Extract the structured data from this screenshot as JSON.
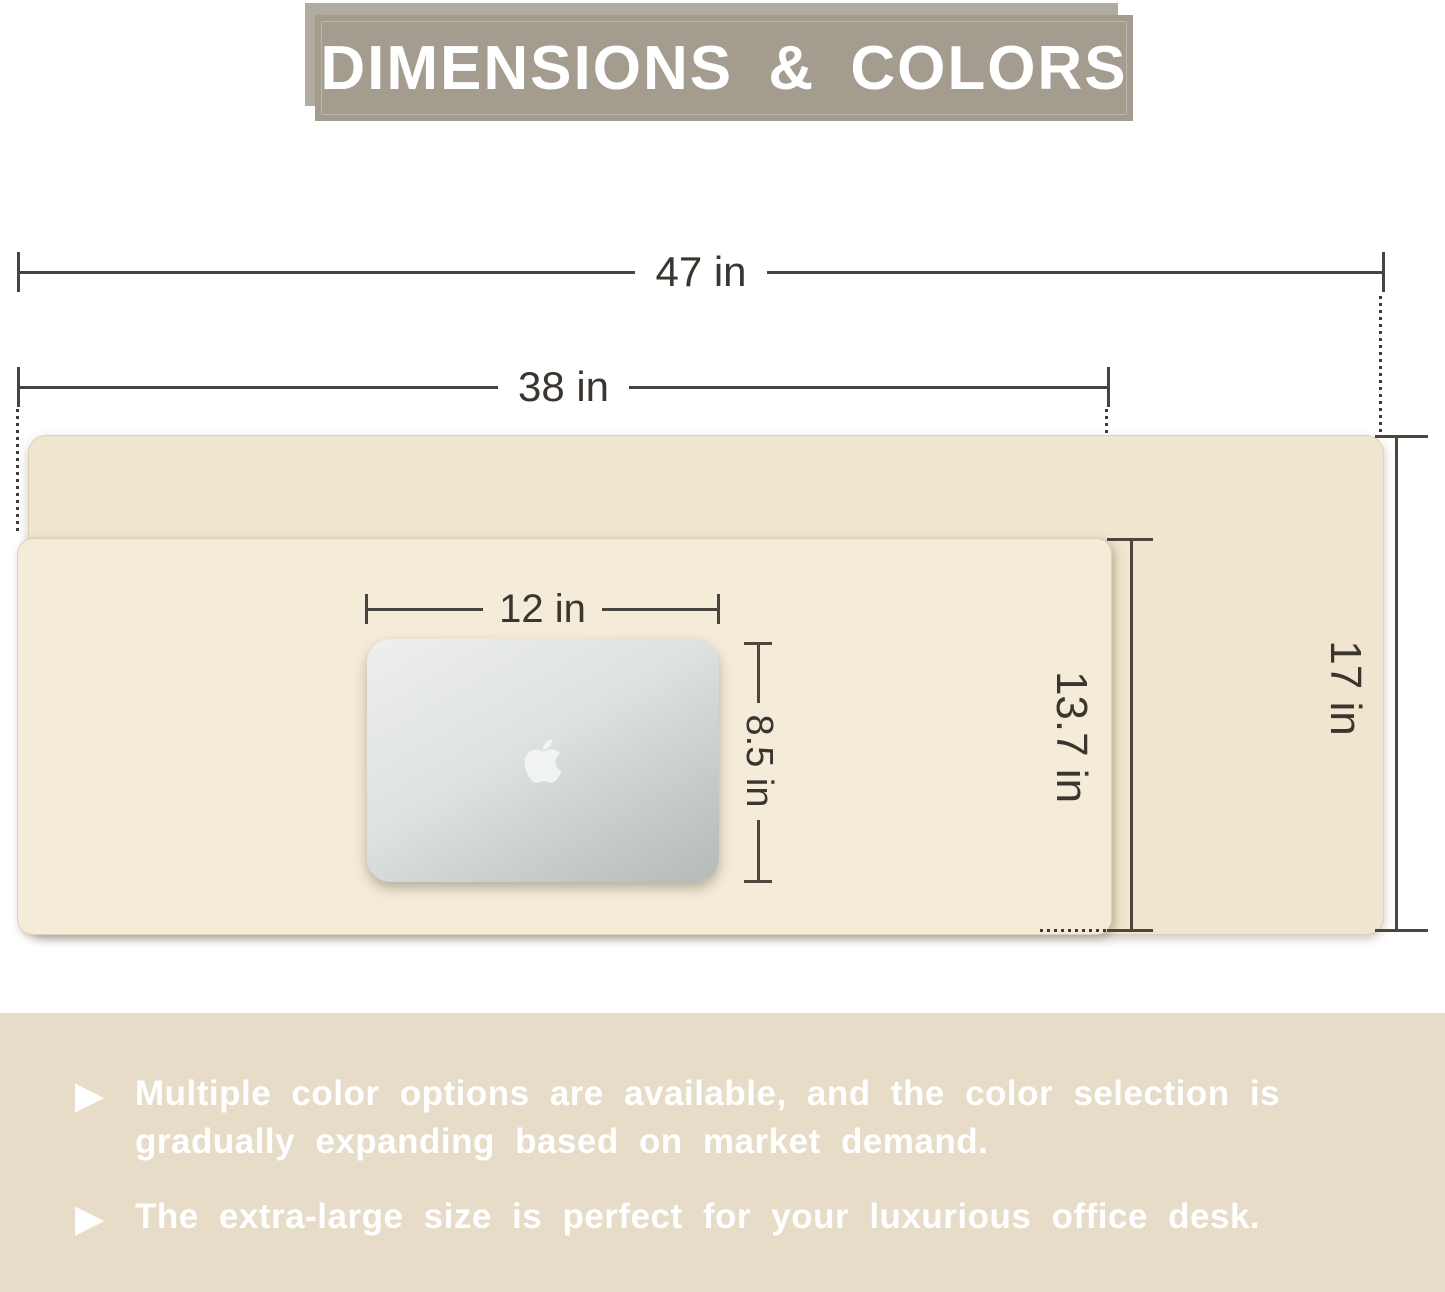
{
  "title": "DIMENSIONS & COLORS",
  "diagram": {
    "large_mat": {
      "width_label": "47 in",
      "height_label": "17 in"
    },
    "small_mat": {
      "width_label": "38 in",
      "height_label": "13.7 in"
    },
    "laptop": {
      "width_label": "12 in",
      "height_label": "8.5 in"
    }
  },
  "features": {
    "bullet_icon": "▶",
    "items": [
      "Multiple color options are available, and the color selection is gradually expanding based on market demand.",
      "The extra-large size is perfect for your luxurious office desk."
    ]
  },
  "colors": {
    "mat_large": "#f0e5ce",
    "mat_small": "#f4ebd9",
    "laptop_silver": "#c9cfcd",
    "banner_front": "#a39c8f",
    "banner_back": "#b2ab9f",
    "feature_band": "#e6dcc8",
    "dim_line": "#4e463c",
    "text_white": "#ffffff"
  }
}
